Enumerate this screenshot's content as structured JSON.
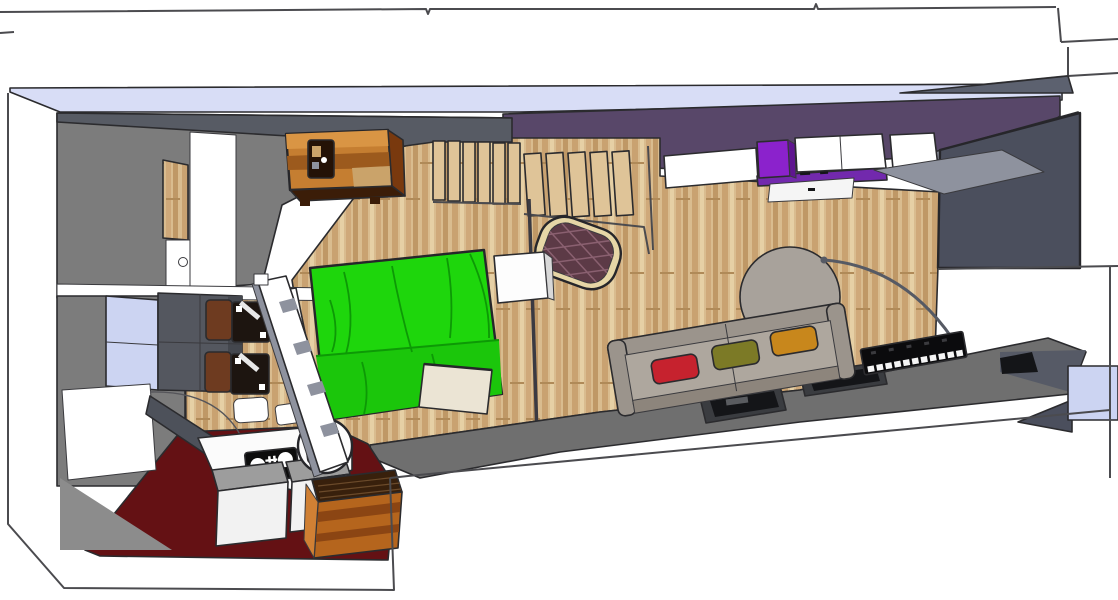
{
  "title": "3D apartment floor plan render (top-down SketchUp style)",
  "palette": {
    "white": "#ffffff",
    "outline": "#2b2b2e",
    "lavender_band": "#d8ddf6",
    "lavender_window": "#ccd4f2",
    "roof_gray": "#5c616f",
    "purple_wall": "#584769",
    "purple_counter": "#7229ad",
    "violet_cabinet": "#8b22cc",
    "violet_side": "#5f1590",
    "slate_wall": "#4b4f5d",
    "dark_wall": "#575b64",
    "gray_room": "#7c7c7c",
    "gray_surface": "#8e929e",
    "wood_base": "#d9bc8f",
    "wood_stripe1": "#c9a271",
    "wood_stripe2": "#e6d0a5",
    "wood_stripe3": "#cfa97a",
    "wood_stripe4": "#bf9866",
    "plank_edge": "#b08a58",
    "stair_plank": "#dfc498",
    "green_bed": "#1ed60c",
    "green_bed_lower": "#1bc60b",
    "green_fold": "#0d9906",
    "maroon_floor": "#641114",
    "pouf_trim": "#e6d6a6",
    "pouf_body": "#5c3a46",
    "pouf_lattice": "#8a6070",
    "cube_white": "#fdfdfd",
    "cube_side": "#d8d8d8",
    "cream_box": "#ebe4d4",
    "dresser_top": "#c57e31",
    "dresser_streak_dark": "#9c5a1d",
    "dresser_streak_light": "#d99544",
    "dresser_patch": "#caa36a",
    "dresser_side": "#79390e",
    "dresser_edge": "#3b1d08",
    "frame_dark": "#241206",
    "rug_gray": "#a8a29b",
    "sofa_frame": "#9b948c",
    "sofa_seat": "#aea79e",
    "sofa_front": "#8d857c",
    "cushion_red": "#c6222e",
    "cushion_olive": "#7c7a26",
    "cushion_orange": "#c8871c",
    "ledge_gray": "#6f6f6f",
    "ledge_dark_strip": "#565a66",
    "recess_frame": "#3a3c40",
    "recess_dark": "#141518",
    "recess_glint": "#5a5c60",
    "keyboard_black": "#0b0b0d",
    "key_white": "#f5f5f5",
    "key_mark": "#3a3a3e",
    "arc_gray": "#565a64",
    "pole_gray": "#3a3a42",
    "window_pane": "#ccd4f2",
    "cabinet_dark": "#54575f",
    "cabinet_darker": "#44474e",
    "door_leaf": "#4d515a",
    "counter_white": "#fbfbfb",
    "stove_black": "#0d0d0d",
    "box_top": "#9d9d9d",
    "box_front": "#f2f2f2",
    "dresserb_front": "#b5651d",
    "dresserb_streak": "#8b4513",
    "dresserb_top": "#38200c",
    "dresserb_slat": "#6b4a2a",
    "dresserb_left": "#d08034",
    "chair_back": "#6e3b20",
    "chair_seat": "#1d1510",
    "chair_glint": "#e8e8e8",
    "table_white": "#fcfcfc",
    "black_obj": "#0d0b09",
    "shadow_gray": "#8c8c8c",
    "drawer_white": "#f5f5f5"
  },
  "scene": {
    "rooms": [
      "entry-corridor",
      "kitchen",
      "bedroom-living-area"
    ],
    "furniture": [
      "dresser",
      "picture-frame",
      "stairs",
      "quilted-pouf",
      "nightstand-cube",
      "green-bed",
      "floor-lamp-pole",
      "cream-cabinet",
      "sofa",
      "round-rug",
      "piano-keyboard",
      "arc-lamp",
      "dining-chairs",
      "desk",
      "round-table",
      "kitchen-stove",
      "island-boxes",
      "kitchen-dresser",
      "open-door",
      "sliding-partition"
    ]
  }
}
